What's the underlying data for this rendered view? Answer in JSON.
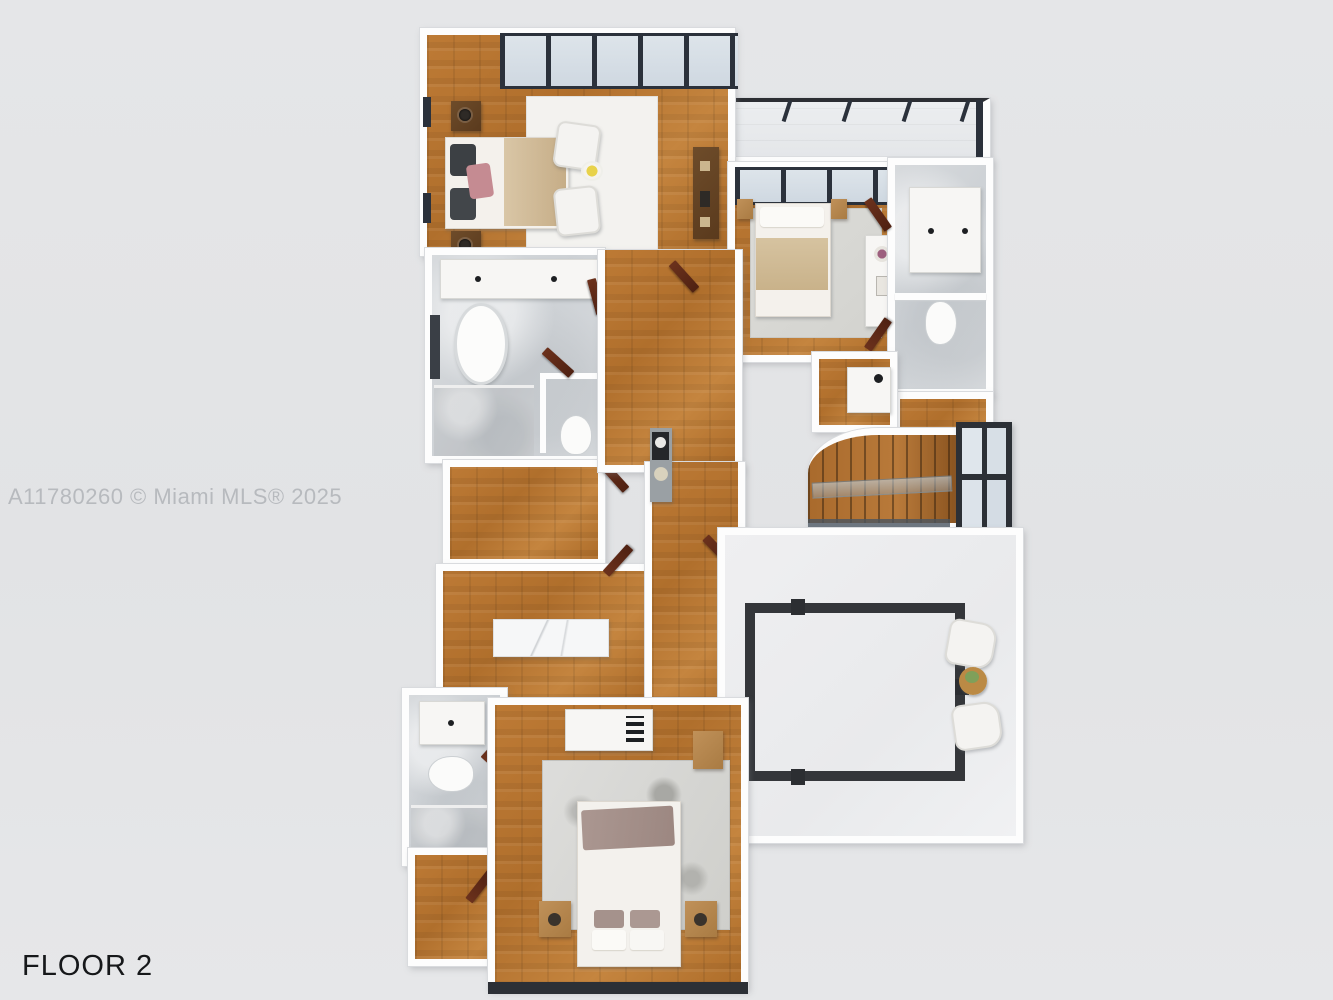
{
  "meta": {
    "watermark": "A11780260 © Miami MLS® 2025",
    "floor_label": "FLOOR 2",
    "type": "3d-floor-plan-top-down-render",
    "background_color": "#e3e4e6"
  },
  "colors": {
    "canvas": "#e3e4e6",
    "watermark_text": "#b7babe",
    "floor_label_text": "#16181a",
    "wall_white": "#fdfdfd",
    "wood_floor": "#b5722f",
    "stair_wood": "#a96a2c",
    "marble_tile": "#d3d6d9",
    "glass_pane": "#d6dee6",
    "window_frame_dark": "#2b313b",
    "door_brown": "#5c2917",
    "dark_wood_furniture": "#63411f",
    "terrace_floor": "#ededef",
    "terrace_frame": "#34363a",
    "rug_white": "#f3f2ef",
    "rug_gray": "#d8d8d4",
    "bed_linen": "#f4f1ec",
    "blanket_tan": "#cbb391",
    "throw_mauve": "#a5928c",
    "pillow_pink": "#c58b92",
    "pillow_dark": "#3c4044"
  },
  "scene": {
    "floor": "Floor 2",
    "rooms": [
      {
        "name": "primary-bedroom",
        "floor_finish": "wood",
        "furniture": [
          "bed with tan blanket and pink pillow",
          "two dark nightstands with lamps",
          "white area rug",
          "two white armchairs",
          "yellow flowers",
          "dresser console"
        ]
      },
      {
        "name": "primary-bathroom",
        "floor_finish": "marble",
        "furniture": [
          "double sink vanity",
          "freestanding oval tub",
          "walk-in shower",
          "water closet with toilet"
        ]
      },
      {
        "name": "closet",
        "floor_finish": "wood",
        "furniture": []
      },
      {
        "name": "walk-in-closet",
        "floor_finish": "wood",
        "furniture": [
          "marble island"
        ]
      },
      {
        "name": "hallway",
        "floor_finish": "wood",
        "furniture": [
          "console table with art and plant"
        ]
      },
      {
        "name": "bedroom-2",
        "floor_finish": "wood",
        "furniture": [
          "bed with tan blanket",
          "light gray rug",
          "desk with flowers",
          "nightstands"
        ]
      },
      {
        "name": "bathroom-2",
        "floor_finish": "marble",
        "furniture": [
          "sink vanity",
          "toilet"
        ]
      },
      {
        "name": "closet-2",
        "floor_finish": "wood",
        "furniture": []
      },
      {
        "name": "laundry-nook",
        "floor_finish": "wood",
        "furniture": [
          "utility sink"
        ]
      },
      {
        "name": "balcony",
        "floor_finish": "tile",
        "furniture": []
      },
      {
        "name": "staircase",
        "floor_finish": "wood treads",
        "furniture": [
          "glass railing",
          "tall window"
        ]
      },
      {
        "name": "terrace",
        "floor_finish": "light concrete",
        "furniture": [
          "open-to-below dark frame",
          "two white lounge chairs",
          "round wood side table with plant"
        ]
      },
      {
        "name": "bathroom-3",
        "floor_finish": "marble",
        "furniture": [
          "sink vanity",
          "toilet",
          "shower"
        ]
      },
      {
        "name": "closet-3",
        "floor_finish": "wood",
        "furniture": []
      },
      {
        "name": "bedroom-3",
        "floor_finish": "wood",
        "furniture": [
          "bed with mauve throw",
          "speckled gray rug",
          "two wood nightstands",
          "desk"
        ]
      }
    ]
  }
}
